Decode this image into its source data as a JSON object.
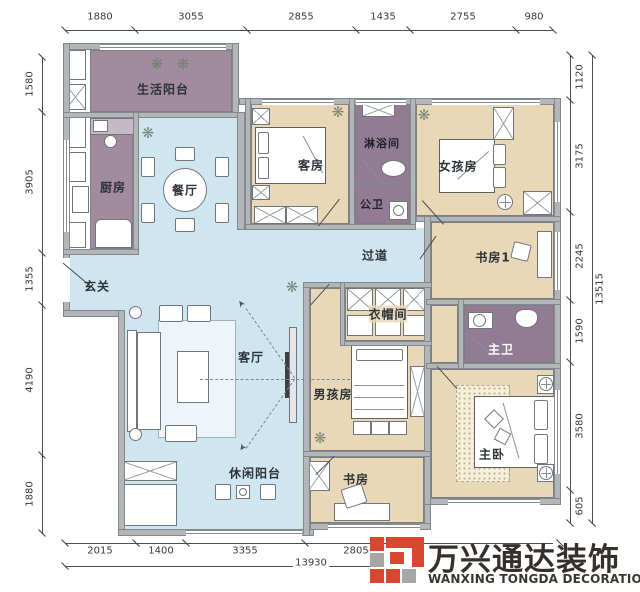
{
  "plan": {
    "rooms": {
      "living_balcony": "生活阳台",
      "kitchen": "厨房",
      "dining": "餐厅",
      "entry": "玄关",
      "living": "客厅",
      "leisure_balcony": "休闲阳台",
      "guest_room": "客房",
      "shower_room": "淋浴间",
      "public_bath": "公卫",
      "corridor": "过道",
      "girl_room": "女孩房",
      "study1": "书房1",
      "cloakroom": "衣帽间",
      "boy_room": "男孩房",
      "master_bath": "主卫",
      "master_bedroom": "主卧",
      "study": "书房"
    },
    "dimensions": {
      "top": [
        "1880",
        "3055",
        "2855",
        "1435",
        "2755",
        "980"
      ],
      "left": [
        "1580",
        "3905",
        "1355",
        "4190",
        "1880"
      ],
      "right": [
        "1120",
        "3175",
        "2245",
        "1590",
        "3580",
        "605"
      ],
      "right_total": "13515",
      "bottom": [
        "2015",
        "1400",
        "3355",
        "2805"
      ],
      "bottom_total": "13930"
    }
  },
  "logo": {
    "name_cn": "万兴通达装饰",
    "name_en": "WANXING TONGDA DECORATION"
  },
  "colors": {
    "floor_open": "#cfe5f0",
    "floor_room": "#e8d8b8",
    "floor_service": "#a18b9d",
    "floor_bath": "#937b94",
    "wall": "#b2b6b9",
    "logo_red": "#d8472f",
    "logo_gray": "#a6a6a6",
    "logo_text": "#35302b"
  }
}
